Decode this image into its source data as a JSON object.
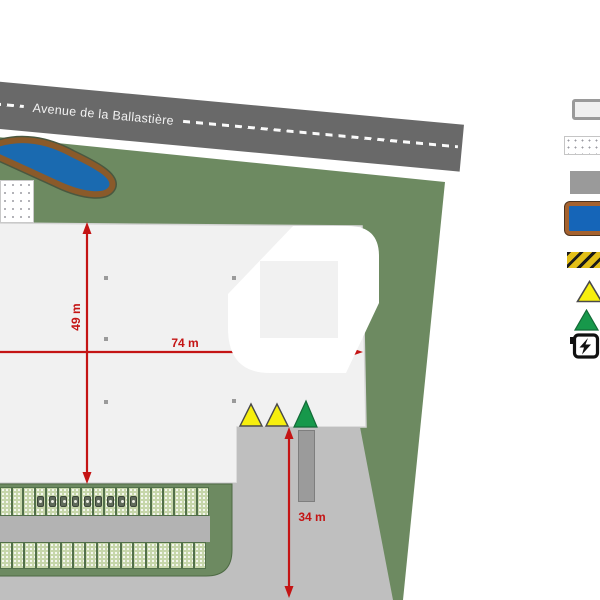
{
  "road": {
    "name": "Avenue de la Ballastière"
  },
  "dimensions": {
    "building_width": "74 m",
    "building_depth": "49 m",
    "yard_depth": "34 m"
  },
  "parking": {
    "top_row_spaces": 18,
    "bottom_row_spaces": 17,
    "ev_equipped_spaces": 9,
    "ev_first_space_index": 3
  },
  "plan_markers": {
    "yellow_triangles": 2,
    "green_triangles": 1
  },
  "legend": {
    "items": [
      {
        "name": "building-outline-swatch"
      },
      {
        "name": "future-extension-dotted-swatch"
      },
      {
        "name": "paved-area-swatch"
      },
      {
        "name": "retention-basin-swatch"
      },
      {
        "name": "hatched-strip-swatch"
      },
      {
        "name": "yellow-triangle-marker"
      },
      {
        "name": "green-triangle-marker"
      },
      {
        "name": "ev-charging-icon"
      }
    ]
  },
  "colors": {
    "road": "#696969",
    "site_green": "#6d8a61",
    "building_fill": "#f1f1f1",
    "paved_gray": "#bfbfbf",
    "basin_blue": "#1565b8",
    "basin_border_brown": "#a5622f",
    "dimension_red": "#c41414",
    "marker_yellow": "#f7ef0e",
    "marker_green": "#17984b",
    "parking_green": "#c6d6aa"
  }
}
